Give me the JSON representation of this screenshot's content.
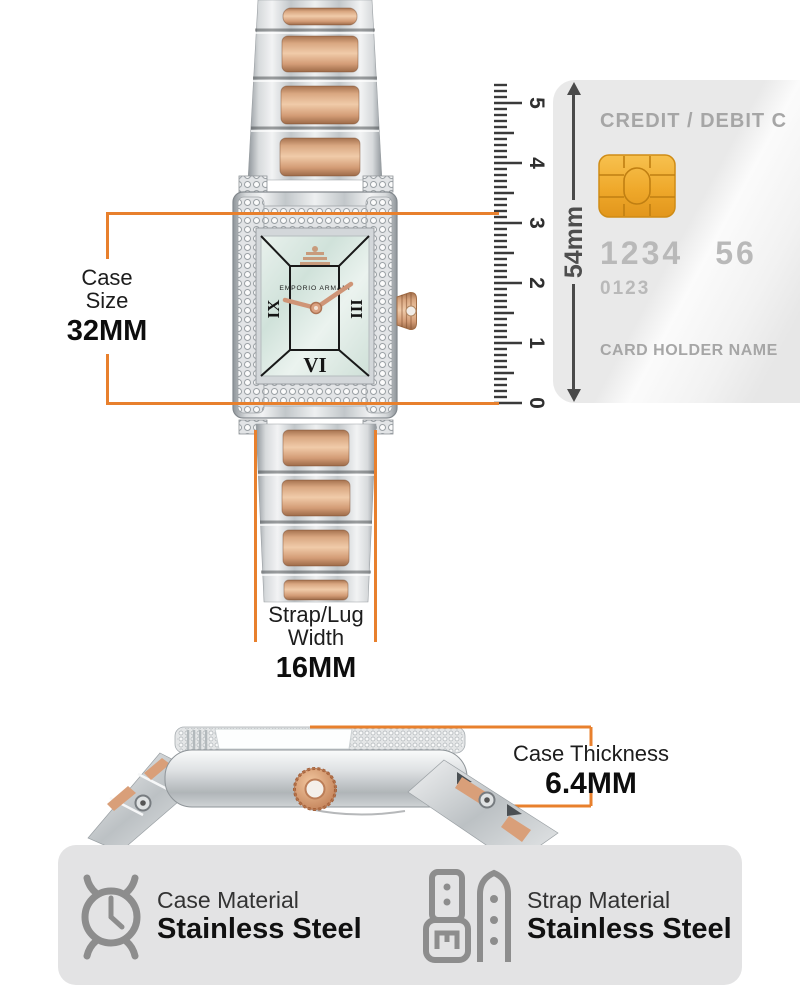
{
  "accent_color": "#e8802d",
  "watch_front": {
    "brand": "EMPORIO ARMANI",
    "numerals": {
      "left": "IX",
      "right": "III",
      "bottom": "VI"
    }
  },
  "annotations": {
    "case_size": {
      "line1": "Case",
      "line2": "Size",
      "value": "32MM"
    },
    "strap_width": {
      "line1": "Strap/Lug",
      "line2": "Width",
      "value": "16MM"
    },
    "case_thickness": {
      "label": "Case Thickness",
      "value": "6.4MM"
    },
    "card_height": {
      "value": "54mm"
    }
  },
  "ruler": {
    "labels": [
      "0",
      "1",
      "2",
      "3",
      "4",
      "5"
    ]
  },
  "credit_card": {
    "title": "CREDIT / DEBIT C",
    "number_part1": "1234",
    "number_part2": "56",
    "secondary_number": "0123",
    "holder_label": "CARD HOLDER NAME"
  },
  "features": [
    {
      "label": "Case Material",
      "value": "Stainless Steel"
    },
    {
      "label": "Strap Material",
      "value": "Stainless Steel"
    }
  ]
}
